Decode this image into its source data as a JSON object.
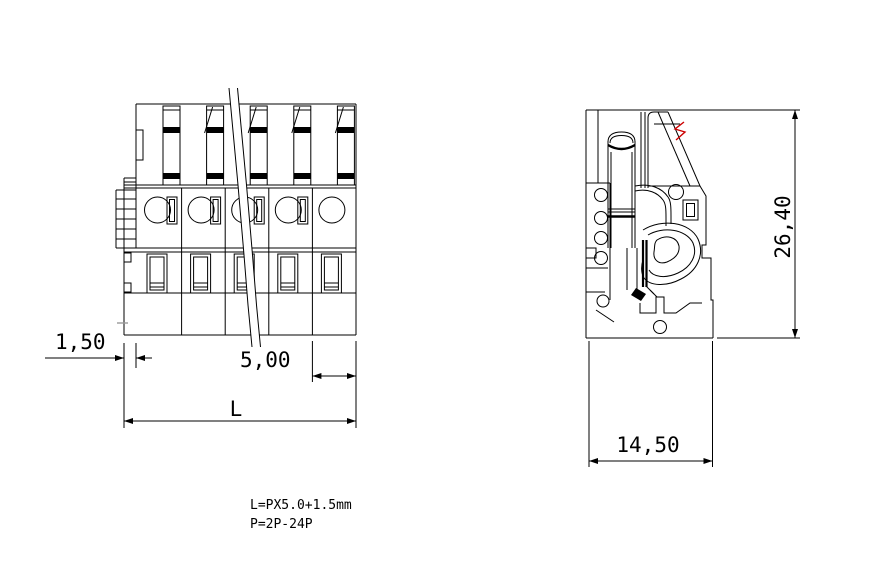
{
  "drawing": {
    "type": "technical-drawing",
    "subject": "pluggable terminal block connector",
    "colors": {
      "background": "#ffffff",
      "line": "#000000",
      "mark": "#cc0000",
      "gray": "#9a9a9a"
    },
    "front_view": {
      "name": "front-view",
      "positions_shown": 5
    },
    "side_view": {
      "name": "side-view"
    },
    "dimensions": {
      "offset": "1,50",
      "pitch": "5,00",
      "overall_length": "L",
      "height": "26,40",
      "depth": "14,50"
    },
    "notes": {
      "line1": "L=PX5.0+1.5mm",
      "line2": "P=2P-24P"
    }
  }
}
